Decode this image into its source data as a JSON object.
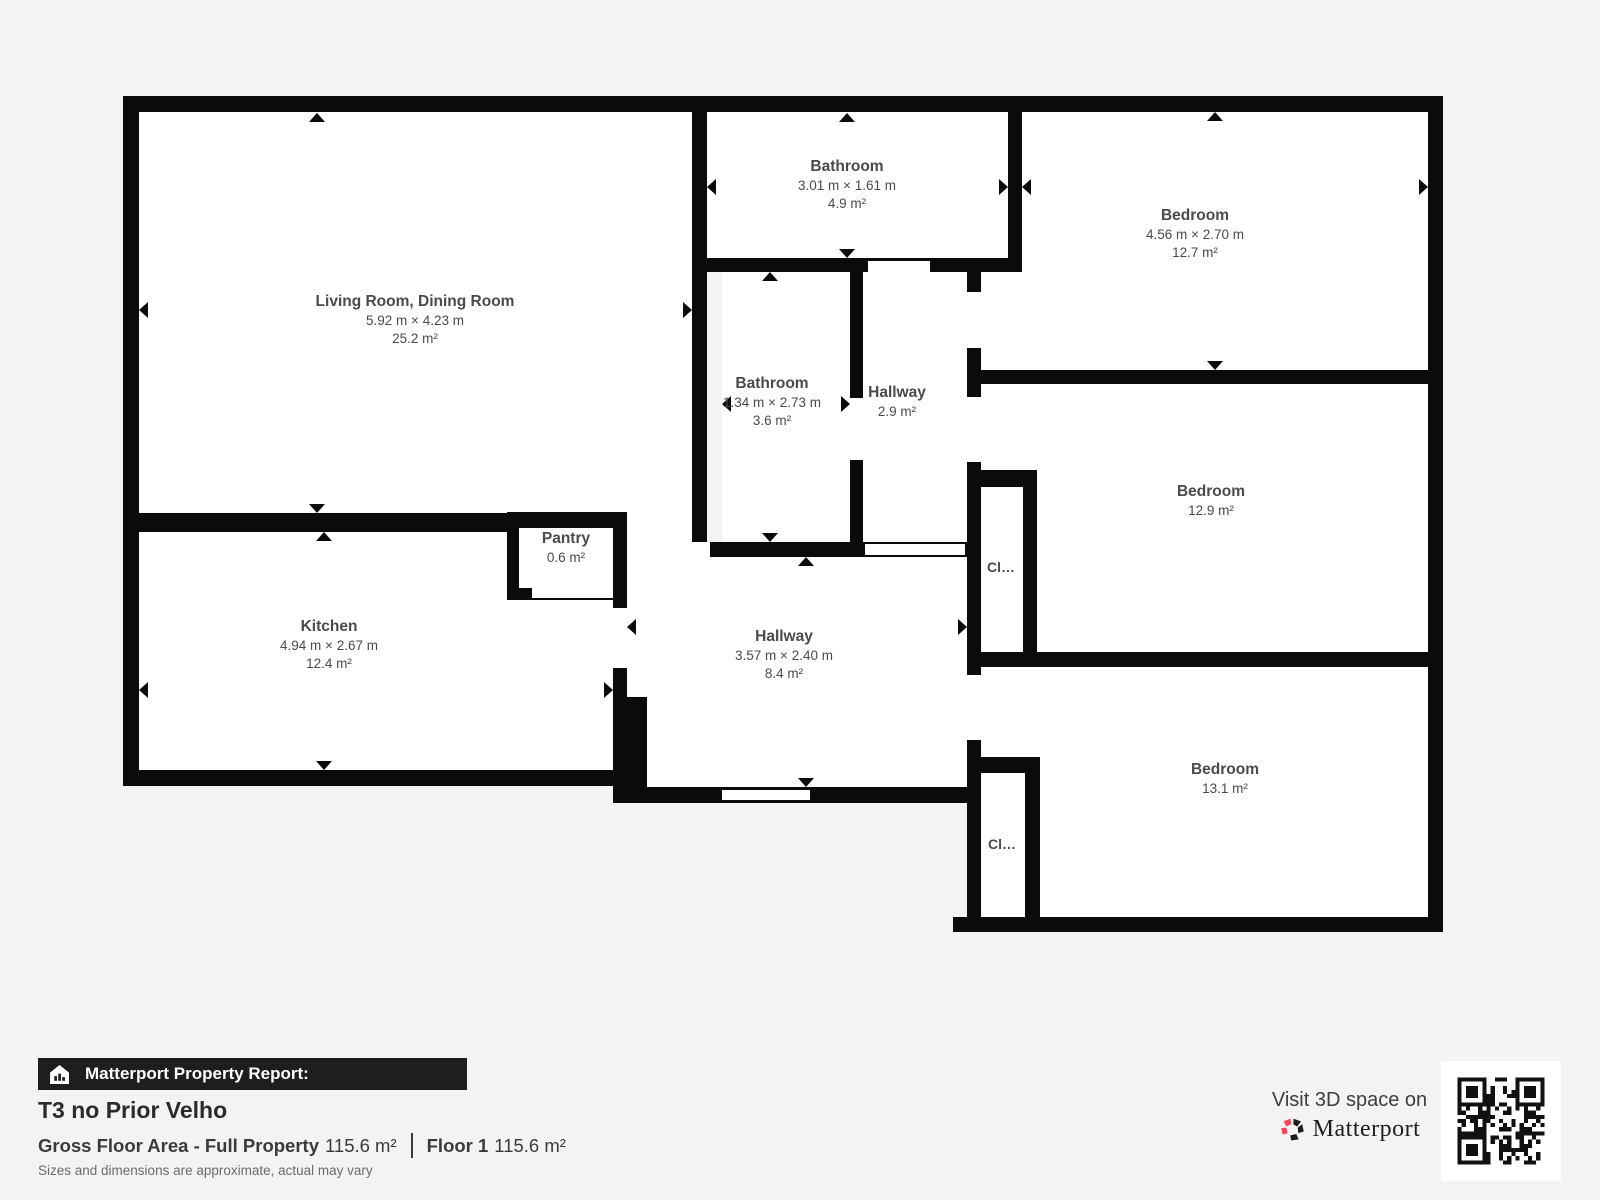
{
  "plan": {
    "rooms": {
      "living": {
        "name": "Living Room, Dining Room",
        "dims": "5.92 m × 4.23 m",
        "area": "25.2 m²"
      },
      "bathroom_top": {
        "name": "Bathroom",
        "dims": "3.01 m × 1.61 m",
        "area": "4.9 m²"
      },
      "bedroom_top": {
        "name": "Bedroom",
        "dims": "4.56 m × 2.70 m",
        "area": "12.7 m²"
      },
      "bathroom_mid": {
        "name": "Bathroom",
        "dims": "1.34 m × 2.73 m",
        "area": "3.6 m²"
      },
      "hallway_small": {
        "name": "Hallway",
        "area": "2.9 m²"
      },
      "bedroom_mid": {
        "name": "Bedroom",
        "area": "12.9 m²"
      },
      "kitchen": {
        "name": "Kitchen",
        "dims": "4.94 m × 2.67 m",
        "area": "12.4 m²"
      },
      "pantry": {
        "name": "Pantry",
        "area": "0.6 m²"
      },
      "hallway_main": {
        "name": "Hallway",
        "dims": "3.57 m × 2.40 m",
        "area": "8.4 m²"
      },
      "bedroom_bottom": {
        "name": "Bedroom",
        "area": "13.1 m²"
      },
      "closet_mid": {
        "name": "Cl…"
      },
      "closet_bottom": {
        "name": "Cl…"
      }
    }
  },
  "footer": {
    "report_label": "Matterport Property Report:",
    "title": "T3 no Prior Velho",
    "gross_label": "Gross Floor Area - Full Property",
    "gross_value": "115.6 m²",
    "floor_label": "Floor 1",
    "floor_value": "115.6 m²",
    "disclaimer": "Sizes and dimensions are approximate, actual may vary"
  },
  "cta": {
    "visit_text": "Visit 3D space on",
    "brand": "Matterport"
  },
  "colors": {
    "background": "#f4f3f1",
    "wall": "#0b0b0b",
    "bar_bg": "#1e1e1e",
    "accent_pink": "#f4435a",
    "label_text": "#4a4a4a"
  }
}
